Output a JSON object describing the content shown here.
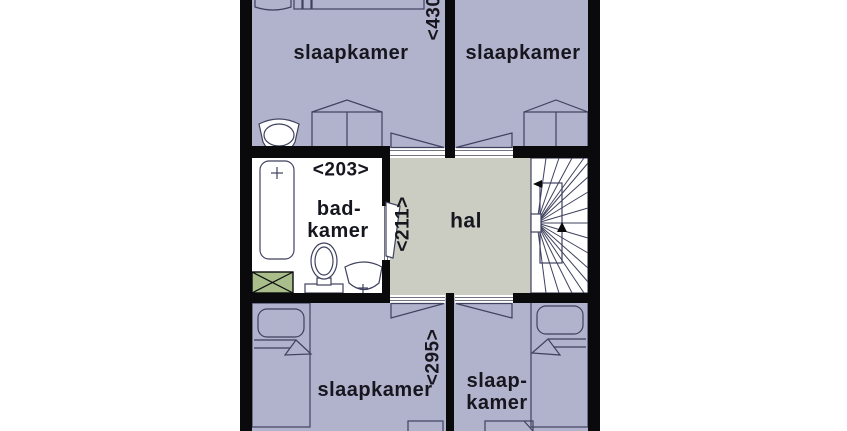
{
  "floorplan": {
    "rooms": {
      "bedroom_top_left": {
        "label": "slaapkamer"
      },
      "bedroom_top_right": {
        "label": "slaapkamer"
      },
      "bathroom": {
        "label_line1": "bad-",
        "label_line2": "kamer"
      },
      "hall": {
        "label": "hal"
      },
      "bedroom_bottom_left": {
        "label": "slaapkamer"
      },
      "bedroom_bottom_right": {
        "label_line1": "slaap-",
        "label_line2": "kamer"
      }
    },
    "dimensions": {
      "top_width": "<430",
      "bathroom_width": "<203>",
      "hall_depth": "<211>",
      "bottom_width": "<295>"
    },
    "symbols": [
      "bed",
      "pillow",
      "wardrobe",
      "bathtub",
      "toilet",
      "washbasin",
      "sink",
      "winder-staircase",
      "duct-shaft",
      "door-leaf"
    ],
    "colors": {
      "background": "#ffffff",
      "bedroom_fill": "#b1b2cb",
      "hall_fill": "#cbccc2",
      "bathroom_fill": "#ffffff",
      "shaft_fill": "#a9be8b",
      "wall": "#0a0a0d",
      "outline": "#3f415e",
      "label": "#16161f"
    }
  }
}
